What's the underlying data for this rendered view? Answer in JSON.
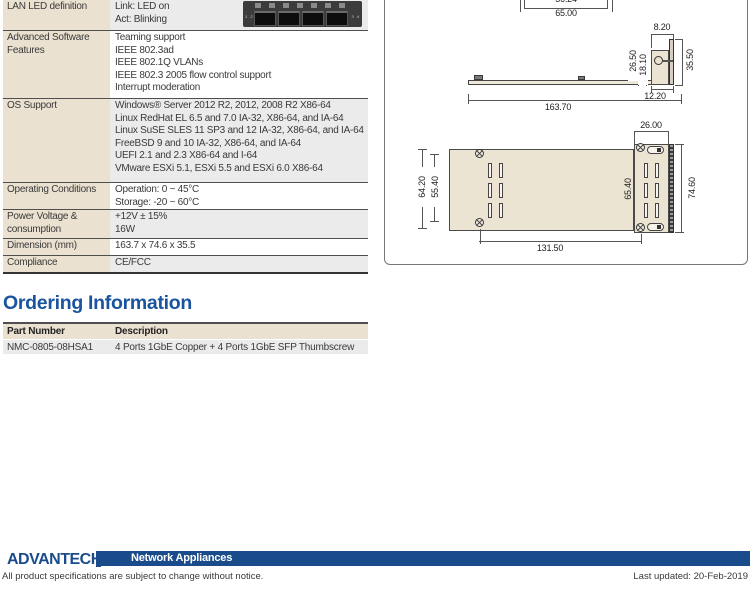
{
  "spec": {
    "rows": [
      {
        "label": "LAN LED definition",
        "values": [
          "Link: LED on",
          "Act: Blinking"
        ]
      },
      {
        "label": "Advanced Software Features",
        "values": [
          "Teaming support",
          "IEEE 802.3ad",
          "IEEE 802.1Q VLANs",
          "IEEE 802.3 2005 flow control support",
          "Interrupt moderation"
        ]
      },
      {
        "label": "OS Support",
        "values": [
          "Windows® Server 2012 R2, 2012, 2008 R2 X86-64",
          "Linux RedHat EL 6.5 and 7.0 IA-32, X86-64, and IA-64",
          "Linux SuSE SLES 11 SP3 and 12 IA-32, X86-64, and IA-64",
          "FreeBSD 9 and 10 IA-32, X86-64, and IA-64",
          "UEFI 2.1 and 2.3 X86-64 and I-64",
          "VMware ESXi 5.1, ESXi 5.5 and ESXi 6.0 X86-64"
        ]
      },
      {
        "label": "Operating Conditions",
        "values": [
          "Operation: 0 ~ 45°C",
          "Storage: -20 ~ 60°C"
        ]
      },
      {
        "label": "Power Voltage & consumption",
        "values": [
          "+12V ± 15%",
          "16W"
        ]
      },
      {
        "label": "Dimension (mm)",
        "values": [
          "163.7 x 74.6 x 35.5"
        ]
      },
      {
        "label": "Compliance",
        "values": [
          "CE/FCC"
        ]
      }
    ],
    "port_labels": {
      "left": "1 2",
      "right": "3 4"
    }
  },
  "ordering": {
    "heading": "Ordering Information",
    "columns": [
      "Part Number",
      "Description"
    ],
    "rows": [
      [
        "NMC-0805-08HSA1",
        "4 Ports 1GbE Copper + 4 Ports 1GbE SFP Thumbscrew"
      ]
    ]
  },
  "drawing": {
    "dims": {
      "top_inner_width": "56.24",
      "top_outer_width": "65.00",
      "tab_width": "8.20",
      "bracket_upper_height": "26.50",
      "bracket_lower_height": "18.10",
      "bracket_total_height": "35.50",
      "bracket_depth": "12.20",
      "board_length": "163.70",
      "bracket_width": "26.00",
      "left_span_outer": "64.20",
      "left_span_inner": "55.40",
      "right_span_inner": "65.40",
      "right_span_outer": "74.60",
      "hole_pitch_length": "131.50"
    }
  },
  "footer": {
    "logo": "ADVANTECH",
    "category": "Network Appliances",
    "disclaimer": "All product specifications are subject to change without notice.",
    "last_updated": "Last updated: 20-Feb-2019",
    "brand_blue": "#1a4c8b",
    "heading_blue": "#1a549e"
  }
}
